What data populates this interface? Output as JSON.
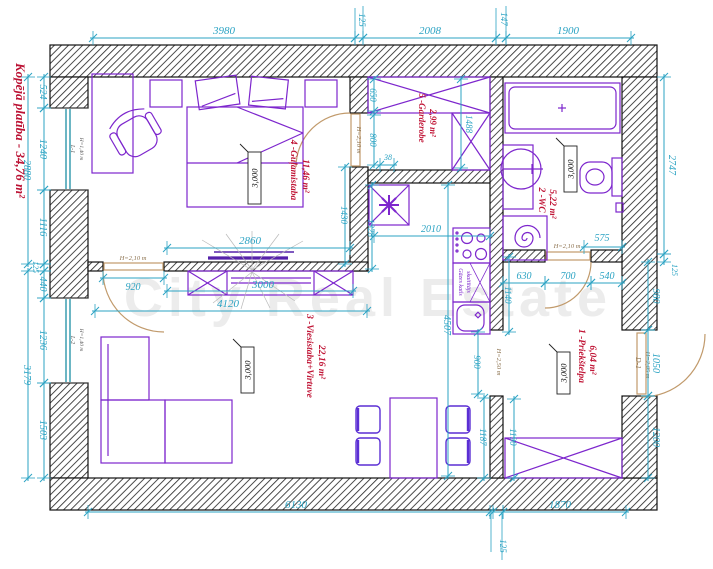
{
  "title": "Kopējā platība - 34,76 m²",
  "watermark": "City Real Estate",
  "ceiling_height": "3,000",
  "rooms": {
    "hall": {
      "name": "1 -Priekštelpa",
      "area": "6,04 m²"
    },
    "wc": {
      "name": "2 -WC",
      "area": "5,22 m²"
    },
    "living": {
      "name": "3 -Viesistaba+Virtuve",
      "area": "22,16 m²"
    },
    "bedroom": {
      "name": "4 -Guļamistaba",
      "area": "11,46 m²"
    },
    "garderobe": {
      "name": "5 -Garderobe",
      "area": "2,99 m²"
    }
  },
  "labels": {
    "gas_boiler_line1": "Gāzes katls",
    "gas_boiler_line2": "skaitītājs",
    "door_d1": "D-1",
    "door_d1_height": "H=2,05 m",
    "door_height": "H=2,10 m",
    "opening_height": "H=2,50 m",
    "window_l1": "L-1",
    "window_l2": "L-2",
    "window_height": "H=1,40 m"
  },
  "dims": {
    "top": [
      "3980",
      "125",
      "2008",
      "147",
      "1900"
    ],
    "bottom": [
      "6130",
      "125",
      "1870"
    ],
    "left_outer": [
      "2880",
      "3179"
    ],
    "left_inner": [
      "524",
      "1240",
      "1116",
      "125",
      "440",
      "1236",
      "1503"
    ],
    "right_outer": [
      "2747",
      "125"
    ],
    "right_inner": [
      "980",
      "1050",
      "1200"
    ],
    "bedroom": [
      "2860",
      "920",
      "1430"
    ],
    "partition": [
      "3000",
      "4120"
    ],
    "garderobe": [
      "650",
      "800",
      "38",
      "1488"
    ],
    "kitchen": [
      "1328",
      "2010",
      "4507",
      "1140",
      "900"
    ],
    "hall": [
      "630",
      "700",
      "540",
      "575",
      "1187",
      "1190"
    ]
  },
  "colors": {
    "dimension": "#2ba3c3",
    "room_label": "#c01536",
    "furniture": "#7d26cd",
    "chair": "#5b2fd4",
    "door": "#c19a6b",
    "wall": "#1a1a1a",
    "window": "#1d8fa3"
  }
}
